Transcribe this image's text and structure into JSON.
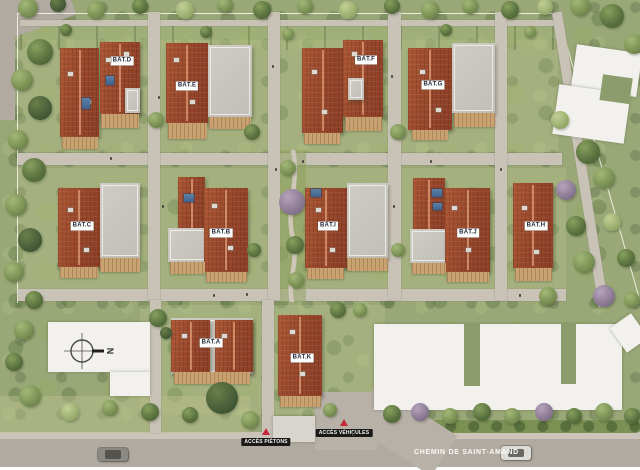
{
  "plan": {
    "buildings": [
      {
        "id": "A",
        "label": "BÂT.A"
      },
      {
        "id": "B",
        "label": "BÂT.B"
      },
      {
        "id": "C",
        "label": "BÂT.C"
      },
      {
        "id": "D",
        "label": "BÂT.D"
      },
      {
        "id": "E",
        "label": "BÂT.E"
      },
      {
        "id": "F",
        "label": "BÂT.F"
      },
      {
        "id": "G",
        "label": "BÂT.G"
      },
      {
        "id": "H",
        "label": "BÂT.H"
      },
      {
        "id": "I",
        "label": "BÂT.I"
      },
      {
        "id": "J",
        "label": "BÂT.J"
      },
      {
        "id": "K",
        "label": "BÂT.K"
      }
    ],
    "access": {
      "pedestrian": "ACCÈS PIÉTONS",
      "vehicles": "ACCÈS VÉHICULES"
    },
    "street_name": "CHEMIN DE SAINT-AMAND",
    "compass": {
      "north_label": "N"
    },
    "colors": {
      "roof_red": "#9c4a2b",
      "flat_roof": "#c8c5bf",
      "deck_wood": "#c8a271",
      "greenery": "#9aa878",
      "path": "#c9c2b6",
      "road": "#b1aaa1",
      "label_text": "#20263c",
      "access_bg": "#191917",
      "access_triangle": "#c5283d",
      "neighbor_building": "#f2f1ee"
    }
  }
}
